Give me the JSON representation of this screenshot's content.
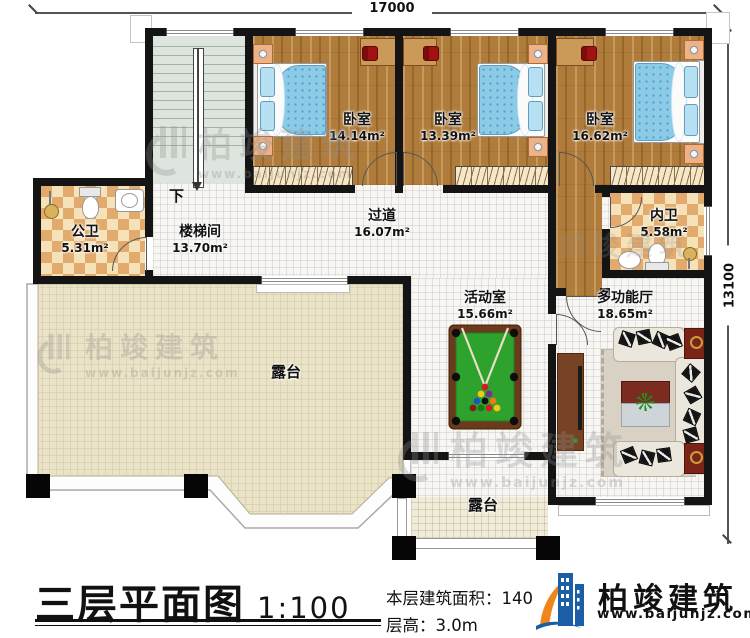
{
  "dims": {
    "top": "17000",
    "right": "13100"
  },
  "rooms": {
    "bedroom1": {
      "name": "卧室",
      "area": "14.14m²"
    },
    "bedroom2": {
      "name": "卧室",
      "area": "13.39m²"
    },
    "bedroom3": {
      "name": "卧室",
      "area": "16.62m²"
    },
    "public_bath": {
      "name": "公卫",
      "area": "5.31m²"
    },
    "stair_room": {
      "name": "楼梯间",
      "area": "13.70m²"
    },
    "corridor": {
      "name": "过道",
      "area": "16.07m²"
    },
    "inner_bath": {
      "name": "内卫",
      "area": "5.58m²"
    },
    "activity": {
      "name": "活动室",
      "area": "15.66m²"
    },
    "multi_hall": {
      "name": "多功能厅",
      "area": "18.65m²"
    },
    "terrace_main": {
      "name": "露台"
    },
    "terrace_small": {
      "name": "露台"
    }
  },
  "stairs": {
    "down_label": "下"
  },
  "footer": {
    "title": "三层平面图",
    "scale": "1:100",
    "area_label": "本层建筑面积：",
    "area_value": "140",
    "height_label": "层高：",
    "height_value": "3.0m"
  },
  "brand": {
    "name": "柏竣建筑",
    "url": "www.baijunjz.com"
  },
  "watermark": {
    "name": "柏竣建筑",
    "url": "www.baijunjz.com"
  },
  "colors": {
    "wall": "#141414",
    "wood_floor": "#b07c3c",
    "bath_tile": "#e2aa6d",
    "terrace_tile": "#ebe3c7",
    "bed_blue": "#8ccbe8",
    "pool_felt": "#2da32d",
    "pool_frame": "#6b3a1c",
    "brand_blue": "#1b5ea6",
    "brand_orange": "#f08519"
  }
}
